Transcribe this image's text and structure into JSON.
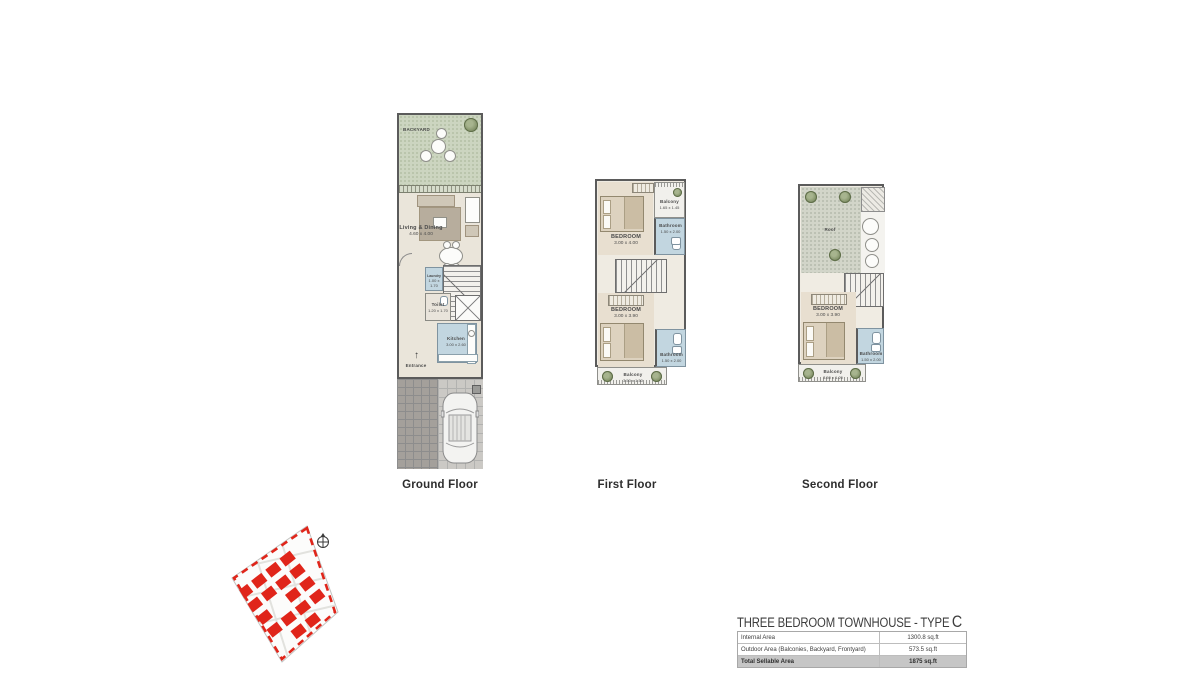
{
  "colors": {
    "accent_red": "#e0251a",
    "wall_gray": "#5b5b5b",
    "backyard_green": "#ccd5c0",
    "floor_beige": "#eae5da",
    "bedroom_beige": "#e8dfd0",
    "wet_room_blue": "#c2d6e0",
    "roof_gray_green": "#d2d5c9",
    "table_highlight_gray": "#c6c6c6"
  },
  "plans": {
    "ground": {
      "label": "Ground Floor",
      "rooms": {
        "backyard": {
          "name": "BACKYARD"
        },
        "living": {
          "name": "Living & Dining",
          "dims": "4.60 x 4.00"
        },
        "laundry": {
          "name": "Laundry",
          "dims": "1.00 x 1.70"
        },
        "toilet": {
          "name": "Toilet",
          "dims": "1.20 x 1.70"
        },
        "kitchen": {
          "name": "Kitchen",
          "dims": "3.00 x 2.60"
        },
        "entrance": {
          "name": "Entrance"
        }
      }
    },
    "first": {
      "label": "First Floor",
      "rooms": {
        "bedroom_top": {
          "name": "BEDROOM",
          "dims": "3.00 x 4.00"
        },
        "balcony_top": {
          "name": "Balcony",
          "dims": "1.65 x 1.45"
        },
        "bathroom_top": {
          "name": "Bathroom",
          "dims": "1.50 x 2.00"
        },
        "bedroom_bottom": {
          "name": "BEDROOM",
          "dims": "3.00 x 3.90"
        },
        "bathroom_bottom": {
          "name": "Bathroom",
          "dims": "1.50 x 2.00"
        },
        "balcony_bottom": {
          "name": "Balcony",
          "dims": "3.50 x 1.50"
        }
      }
    },
    "second": {
      "label": "Second Floor",
      "rooms": {
        "roof": {
          "name": "Roof"
        },
        "bedroom": {
          "name": "BEDROOM",
          "dims": "3.00 x 3.90"
        },
        "bathroom": {
          "name": "Bathroom",
          "dims": "1.50 x 2.00"
        },
        "balcony": {
          "name": "Balcony",
          "dims": "3.50 x 1.20"
        }
      }
    }
  },
  "summary": {
    "title": "THREE BEDROOM TOWNHOUSE - TYPE",
    "type_letter": "C",
    "rows": [
      {
        "label": "Internal Area",
        "value": "1300.8 sq.ft"
      },
      {
        "label": "Outdoor Area (Balconies, Backyard, Frontyard)",
        "value": "573.5 sq.ft"
      },
      {
        "label": "Total Sellable Area",
        "value": "1875 sq.ft"
      }
    ]
  }
}
